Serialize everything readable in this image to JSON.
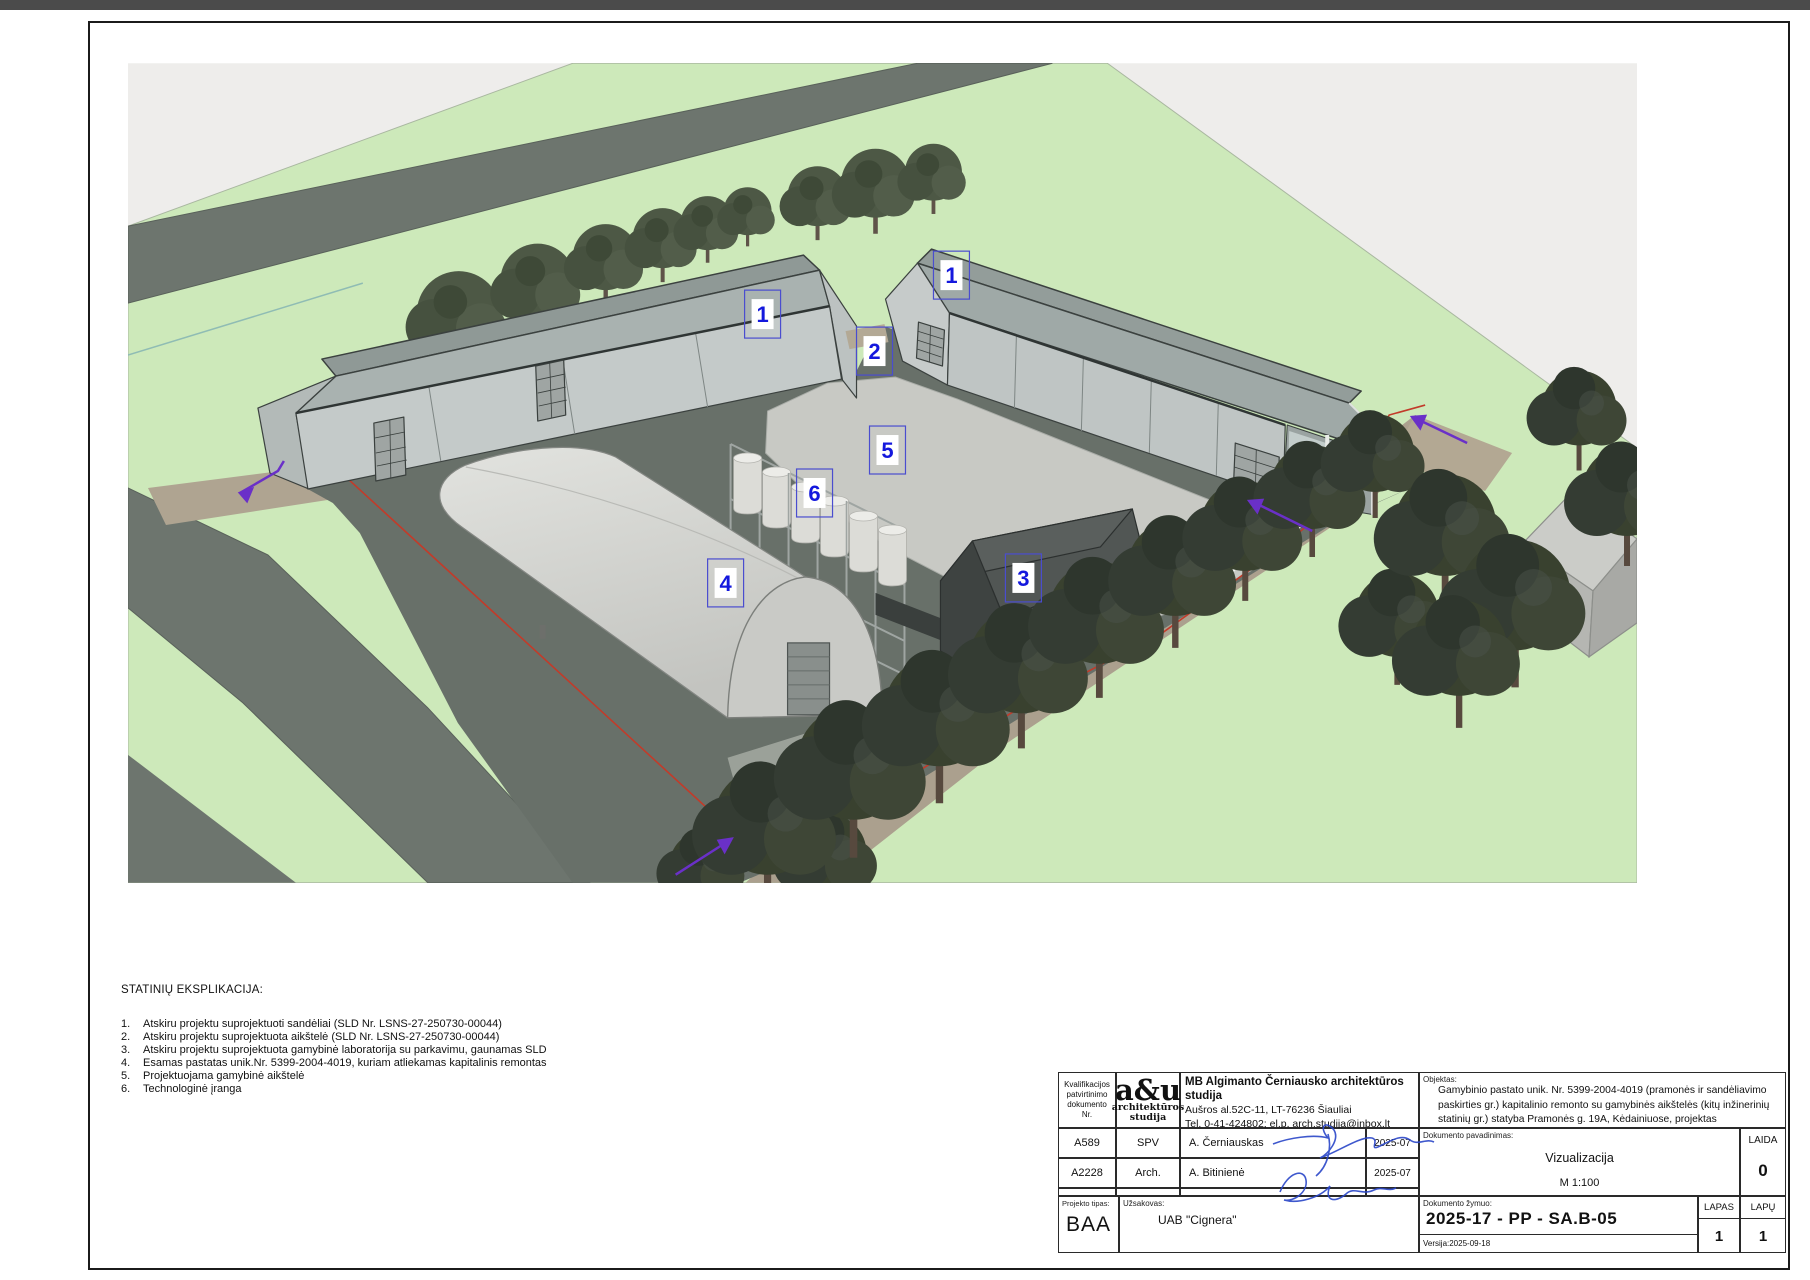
{
  "legend": {
    "title": "STATINIŲ EKSPLIKACIJA:",
    "items": [
      {
        "no": "1.",
        "text": "Atskiru projektu suprojektuoti sandėliai  (SLD Nr. LSNS-27-250730-00044)"
      },
      {
        "no": "2.",
        "text": "Atskiru projektu suprojektuota aikštelė (SLD Nr. LSNS-27-250730-00044)"
      },
      {
        "no": "3.",
        "text": "Atskiru projektu suprojektuota gamybinė laboratorija su parkavimu, gaunamas SLD"
      },
      {
        "no": "4.",
        "text": "Esamas pastatas unik.Nr. 5399-2004-4019, kuriam atliekamas kapitalinis remontas"
      },
      {
        "no": "5.",
        "text": "Projektuojama gamybinė aikštelė"
      },
      {
        "no": "6.",
        "text": "Technologinė įranga"
      }
    ]
  },
  "markers": [
    {
      "num": "1"
    },
    {
      "num": "1"
    },
    {
      "num": "2"
    },
    {
      "num": "3"
    },
    {
      "num": "4"
    },
    {
      "num": "5"
    },
    {
      "num": "6"
    }
  ],
  "titleblock": {
    "qualification_header": "Kvalifikacijos\npatvirtinimo\ndokumento\nNr.",
    "logo": {
      "big": "a&u",
      "sub1": "architektūros",
      "sub2": "studija"
    },
    "company": {
      "name": "MB Algimanto Černiausko architektūros studija",
      "address": "Aušros al.52C-11, LT-76236 Šiauliai",
      "contacts": "Tel. 0-41-424802; el.p. arch.studija@inbox.lt"
    },
    "rows": [
      {
        "cert": "A589",
        "role": "SPV",
        "name": "A. Černiauskas",
        "date": "2025-07"
      },
      {
        "cert": "A2228",
        "role": "Arch.",
        "name": "A. Bitinienė",
        "date": "2025-07"
      }
    ],
    "project_type": {
      "label": "Projekto tipas:",
      "value": "BAA"
    },
    "client": {
      "label": "Užsakovas:",
      "value": "UAB \"Cignera\""
    },
    "object": {
      "label": "Objektas:",
      "text": "Gamybinio pastato unik. Nr. 5399-2004-4019 (pramonės ir sandėliavimo paskirties gr.) kapitalinio remonto su gamybinės aikštelės (kitų inžinerinių statinių gr.) statyba Pramonės g. 19A, Kėdainiuose, projektas"
    },
    "doc_name": {
      "label": "Dokumento pavadinimas:",
      "title": "Vizualizacija",
      "scale": "M 1:100"
    },
    "laida": {
      "label": "LAIDA",
      "value": "0"
    },
    "doc_code": {
      "label": "Dokumento žymuo:",
      "value": "2025-17 - PP - SA.B-05"
    },
    "version": "Versija:2025-09-18",
    "lapas": {
      "label": "LAPAS",
      "value": "1"
    },
    "lapu": {
      "label": "LAPŲ",
      "value": "1"
    }
  },
  "colors": {
    "grass": "#cde9ba",
    "road": "#6d756e",
    "yard": "#c8c9c4",
    "asphalt": "#687069",
    "marker_blue": "#1418dd",
    "boundary_red": "#c23b2a",
    "arrow_purple": "#6a30c8"
  }
}
